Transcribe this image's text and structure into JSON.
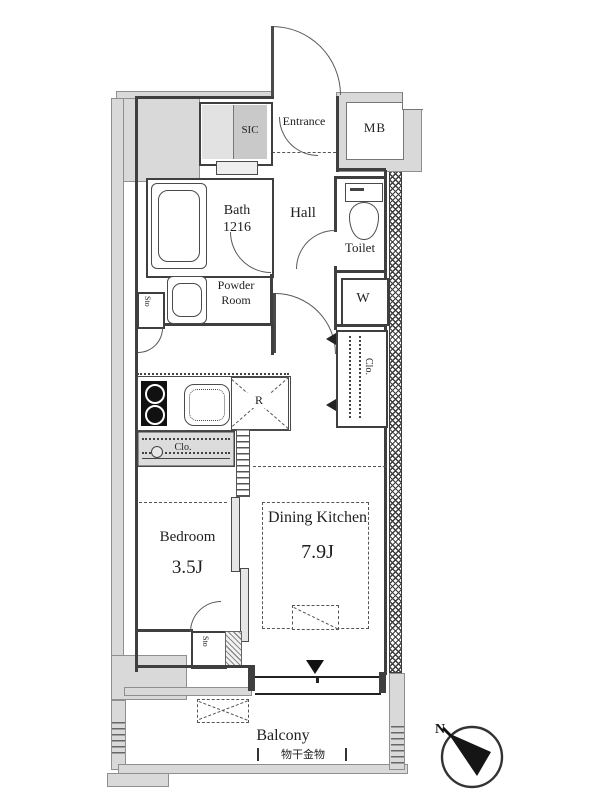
{
  "floorplan": {
    "rooms": {
      "entrance": {
        "label": "Entrance"
      },
      "sic": {
        "label": "SIC"
      },
      "mb": {
        "label": "MB"
      },
      "bath": {
        "name": "Bath",
        "size": "1216"
      },
      "hall": {
        "label": "Hall"
      },
      "toilet": {
        "label": "Toilet"
      },
      "washer": {
        "label": "W"
      },
      "powder_room": {
        "line1": "Powder",
        "line2": "Room"
      },
      "storage_upper": {
        "label": "Sto"
      },
      "storage_lower": {
        "label": "Sto"
      },
      "refrigerator": {
        "label": "R"
      },
      "closet_kitchen": {
        "label": "Clo."
      },
      "closet_dk": {
        "label": "Clo."
      },
      "bedroom": {
        "name": "Bedroom",
        "size": "3.5J"
      },
      "dining_kitchen": {
        "name": "Dining Kitchen",
        "size": "7.9J"
      },
      "balcony": {
        "label": "Balcony",
        "laundry_fixture": "物干金物"
      }
    },
    "compass": {
      "north": "N"
    },
    "colors": {
      "wall": "#3f3f3f",
      "structure_fill": "#d9d9d9",
      "shade_fill": "#c9c9c9",
      "line": "#555555",
      "background": "#ffffff"
    }
  }
}
